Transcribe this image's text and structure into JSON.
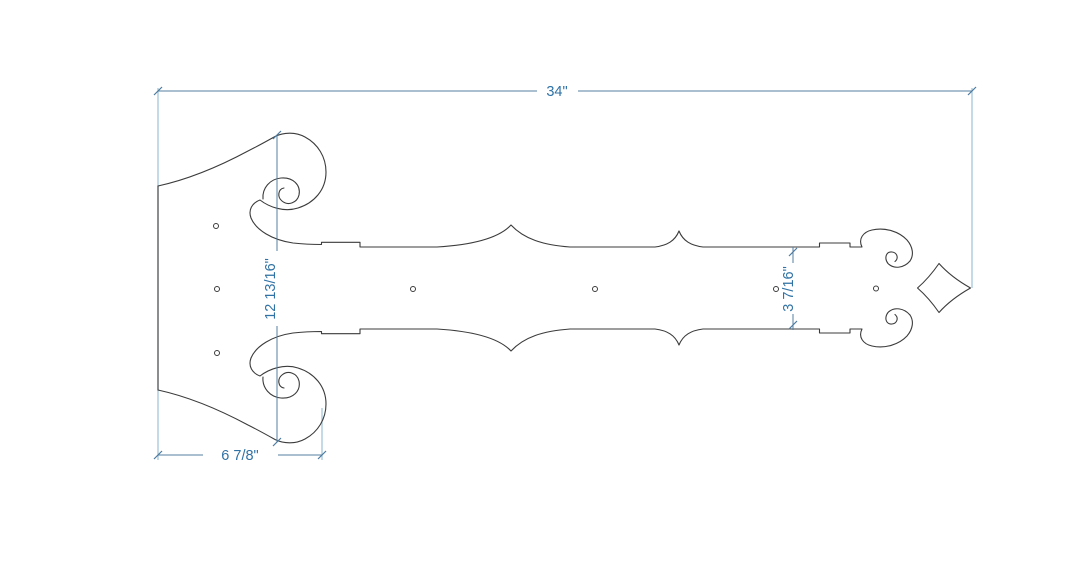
{
  "drawing": {
    "kind": "technical-dimension-drawing",
    "subject": "decorative strap hinge with scrolled backplate and fleur-de-lis tip",
    "labels": {
      "overall_length": "34\"",
      "plate_height": "12 13/16\"",
      "plate_width": "6 7/8\"",
      "strap_width": "3 7/16\""
    },
    "holes": {
      "count": 7,
      "plate_holes": 3,
      "strap_holes": 4
    },
    "colors": {
      "background": "#ffffff",
      "part_outline": "#3b3b3b",
      "dimension_line": "#5581a3",
      "extension_line": "#9cc2d4",
      "dimension_text": "#2f72a5"
    }
  }
}
